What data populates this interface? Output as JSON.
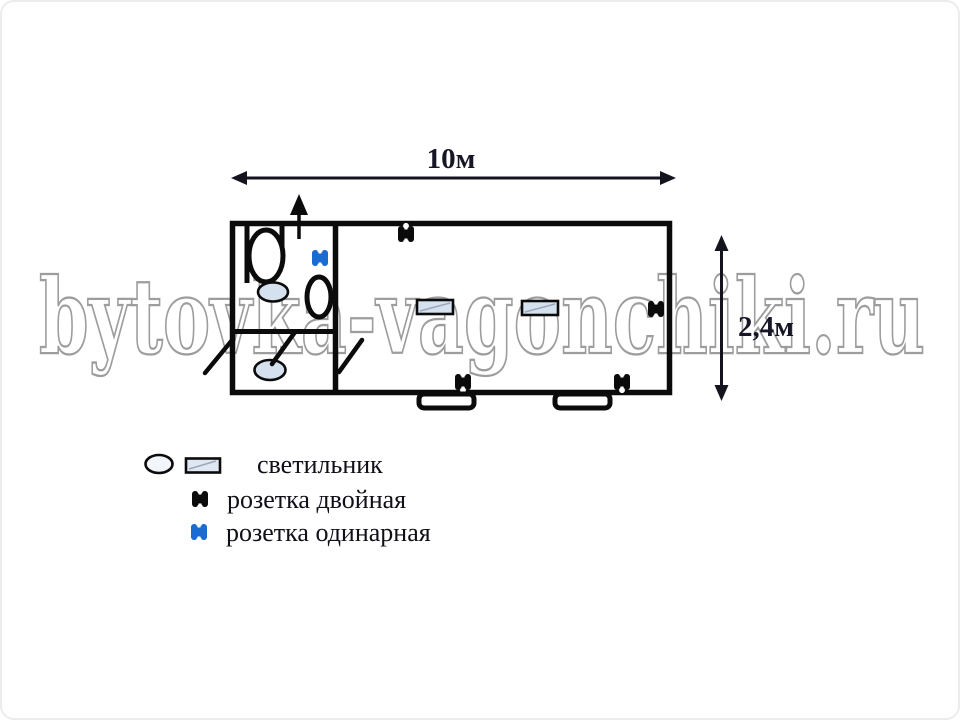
{
  "watermark": "bytovka-vagonchiki.ru",
  "dimensions": {
    "width_label": "10м",
    "height_label": "2,4м"
  },
  "legend": {
    "items": [
      {
        "icon": "light-fixture-icon",
        "label": "светильник"
      },
      {
        "icon": "double-socket-icon",
        "label": "розетка двойная"
      },
      {
        "icon": "single-socket-icon",
        "label": "розетка одинарная"
      }
    ]
  },
  "diagram": {
    "type": "floor-plan",
    "fixture_counts": {
      "oval_ceiling_lights": 2,
      "rect_ceiling_lights": 2,
      "double_sockets": 4,
      "single_sockets": 1,
      "toilets": 1,
      "sinks": 1,
      "windows": 2,
      "door_swings": 3,
      "entrance_arrows": 1
    }
  },
  "colors": {
    "walls": "#0b0b0b",
    "light_fixture_fill": "#d6e1ef",
    "double_socket": "#0b0b0b",
    "single_socket": "#1b6cd2",
    "watermark_outline": "#9d9d9d",
    "label_text": "#161627"
  }
}
